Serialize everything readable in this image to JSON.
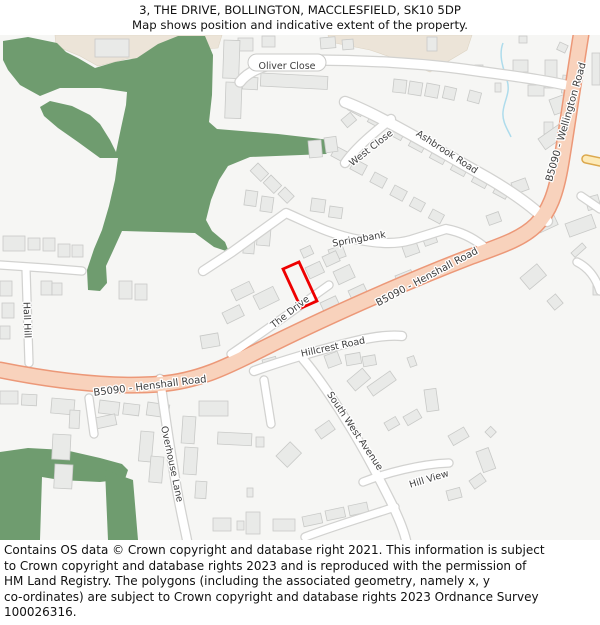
{
  "header": {
    "title": "3, THE DRIVE, BOLLINGTON, MACCLESFIELD, SK10 5DP",
    "subtitle": "Map shows position and indicative extent of the property."
  },
  "map": {
    "labels": {
      "oliver_close": "Oliver Close",
      "west_close": "West Close",
      "ashbrook_road": "Ashbrook Road",
      "springbank": "Springbank",
      "wellington_road": "B5090 - Wellington Road",
      "henshall_road_west": "B5090 - Henshall Road",
      "henshall_road_east": "B5090 - Henshall Road",
      "the_drive": "The Drive",
      "hillcrest_road": "Hillcrest Road",
      "south_west_avenue": "South West Avenue",
      "hill_view": "Hill View",
      "overhouse_lane": "Overhouse Lane",
      "hall_hill": "Hall Hill"
    },
    "marker": {
      "description": "Red outline marking position and extent of 3 The Drive",
      "color": "#ee0000"
    },
    "colors": {
      "greenspace": "#6f9c6f",
      "beige_area": "#ece4d8",
      "a_road_fill": "#f8d2bc",
      "a_road_border": "#ec9878",
      "yellow_road_fill": "#fdeab8",
      "yellow_road_border": "#dca94e",
      "minor_road_fill": "#ffffff",
      "minor_road_border": "#d2d2d0",
      "building_fill": "#e9eae8",
      "building_border": "#c8c9c7",
      "water": "#aedcec",
      "background": "#f6f6f4",
      "label_text": "#3d3d3d"
    }
  },
  "footer": {
    "lines": [
      "Contains OS data © Crown copyright and database right 2021. This information is subject",
      "to Crown copyright and database rights 2023 and is reproduced with the permission of",
      "HM Land Registry. The polygons (including the associated geometry, namely x, y",
      "co-ordinates) are subject to Crown copyright and database rights 2023 Ordnance Survey",
      "100026316."
    ]
  }
}
